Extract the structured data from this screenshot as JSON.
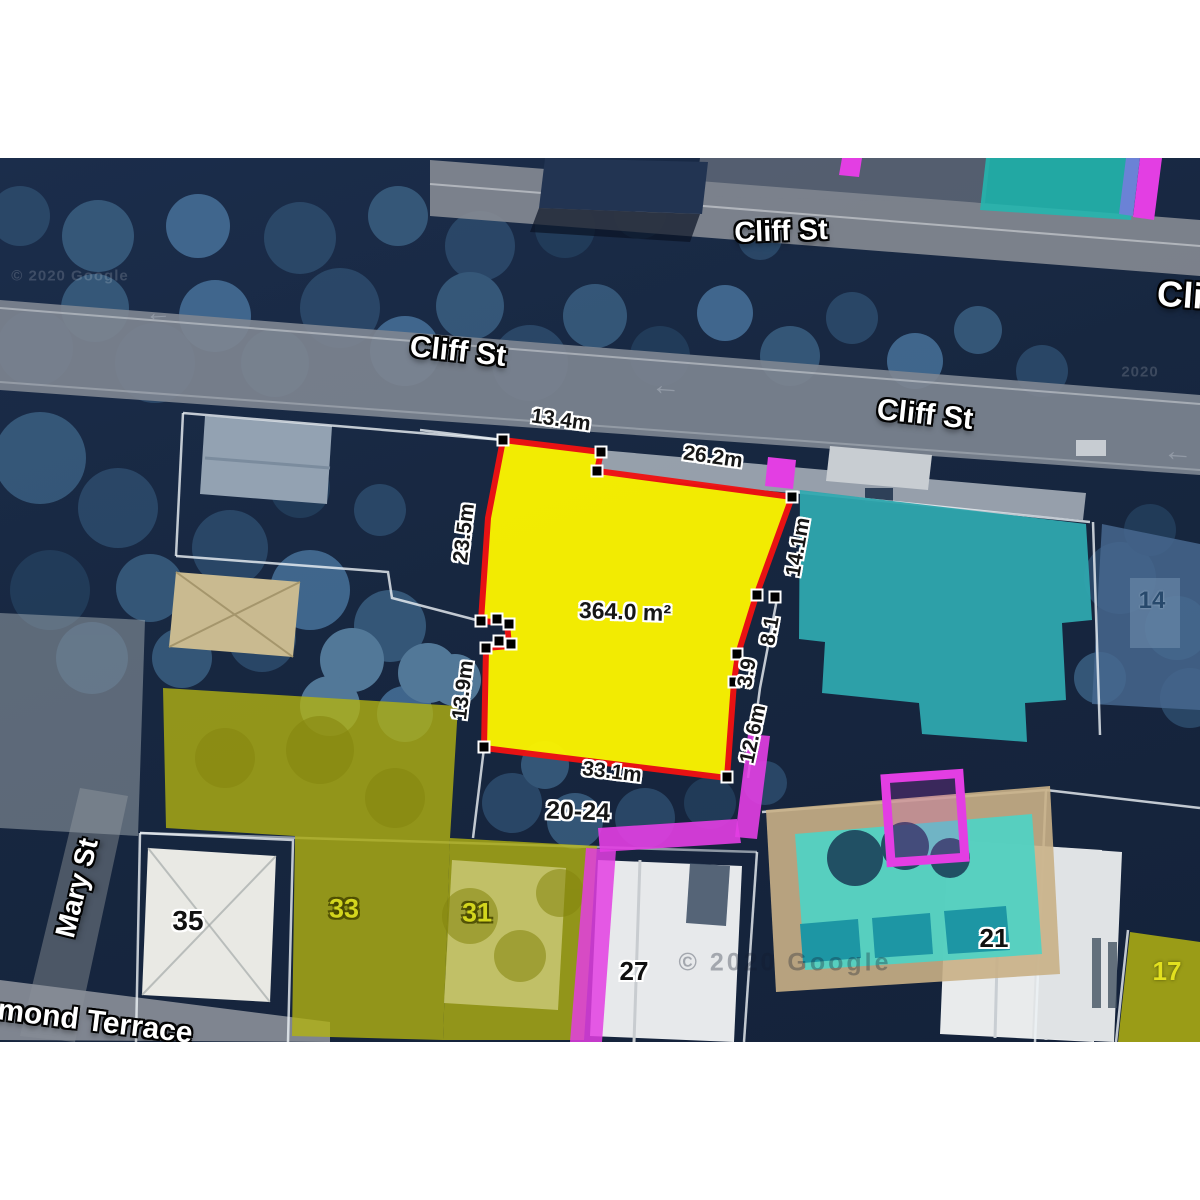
{
  "map": {
    "streets": {
      "cliff_top": "Cliff St",
      "cliff_mid": "Cliff St",
      "cliff_right": "Cliff St",
      "cliff_edge_clipped": "Cliff",
      "mary": "Mary St",
      "terrace_clipped": "mond Terrace"
    },
    "subject_parcel": {
      "area_label": "364.0 m²",
      "address_label": "20-24",
      "dimensions": {
        "top_left": "13.4m",
        "top_right": "26.2m",
        "left_upper": "23.5m",
        "left_lower": "13.9m",
        "right_upper": "14.1m",
        "right_mid_upper": "8.1",
        "right_mid_lower": "3.9",
        "right_lower": "12.6m",
        "bottom": "33.1m"
      },
      "fill_color": "#FBF400",
      "outline_color": "#F11212"
    },
    "lot_numbers": {
      "lot_35": "35",
      "lot_33": "33",
      "lot_31": "31",
      "lot_27": "27",
      "lot_21": "21",
      "lot_17": "17",
      "lot_14": "14"
    },
    "overlay_colors": {
      "teal_building": "#2EA7AE",
      "teal_parcel": "#23B6AE",
      "olive_parcels": "#B1B112",
      "magenta_paths": "#E33EE3",
      "pool_turquoise": "#4ED2C4",
      "road_grey": "#7D8490"
    },
    "attribution": {
      "left": "© 2020 Google",
      "center": "© 2020 Google",
      "right_fragment": "2020"
    },
    "icons": {
      "pan_arrow_left": "←"
    }
  }
}
